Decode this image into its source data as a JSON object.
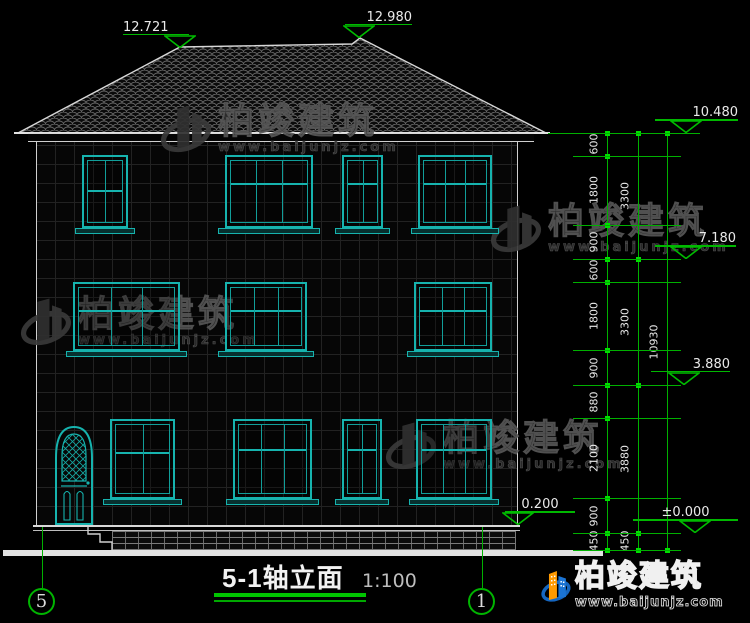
{
  "drawing": {
    "title": "5-1轴立面",
    "scale_label": "1:100",
    "axis_left": "5",
    "axis_right": "1",
    "elevations": [
      {
        "label": "12.721",
        "value": 12.721
      },
      {
        "label": "12.980",
        "value": 12.98
      },
      {
        "label": "10.480",
        "value": 10.48
      },
      {
        "label": "7.180",
        "value": 7.18
      },
      {
        "label": "3.880",
        "value": 3.88
      },
      {
        "label": "0.200",
        "value": 0.2
      },
      {
        "label": "±0.000",
        "value": 0.0
      }
    ],
    "dim_chains": {
      "inner": [
        600,
        1800,
        900,
        600,
        1800,
        900,
        880,
        2100,
        900,
        450
      ],
      "middle": [
        3300,
        3300,
        3880,
        450
      ],
      "outer": [
        10930
      ]
    },
    "floors": [
      {
        "name": "floor-3",
        "y": 155,
        "h": 73,
        "openings": [
          {
            "x": 82,
            "w": 46,
            "cols": 2,
            "transom": 0.4
          },
          {
            "x": 225,
            "w": 88,
            "cols": 3,
            "transom": 0.3
          },
          {
            "x": 342,
            "w": 41,
            "cols": 2,
            "transom": 0.3
          },
          {
            "x": 418,
            "w": 74,
            "cols": 3,
            "transom": 0.3
          }
        ]
      },
      {
        "name": "floor-2",
        "y": 282,
        "h": 69,
        "openings": [
          {
            "x": 73,
            "w": 107,
            "cols": 3,
            "transom": 0.32
          },
          {
            "x": 225,
            "w": 82,
            "cols": 3,
            "transom": 0.32
          },
          {
            "x": 414,
            "w": 78,
            "cols": 3,
            "transom": 0.32
          }
        ]
      },
      {
        "name": "floor-1",
        "y": 419,
        "h": 80,
        "openings": [
          {
            "x": 110,
            "w": 65,
            "cols": 2,
            "transom": 0.34
          },
          {
            "x": 233,
            "w": 79,
            "cols": 3,
            "transom": 0.3
          },
          {
            "x": 342,
            "w": 40,
            "cols": 2,
            "transom": 0.3
          },
          {
            "x": 416,
            "w": 76,
            "cols": 3,
            "transom": 0.3
          }
        ]
      }
    ],
    "watermark": {
      "brand": "柏竣建筑",
      "site": "www.baijunjz.com"
    },
    "logo": {
      "brand": "柏竣建筑",
      "site": "www.baijunjz.com"
    }
  }
}
